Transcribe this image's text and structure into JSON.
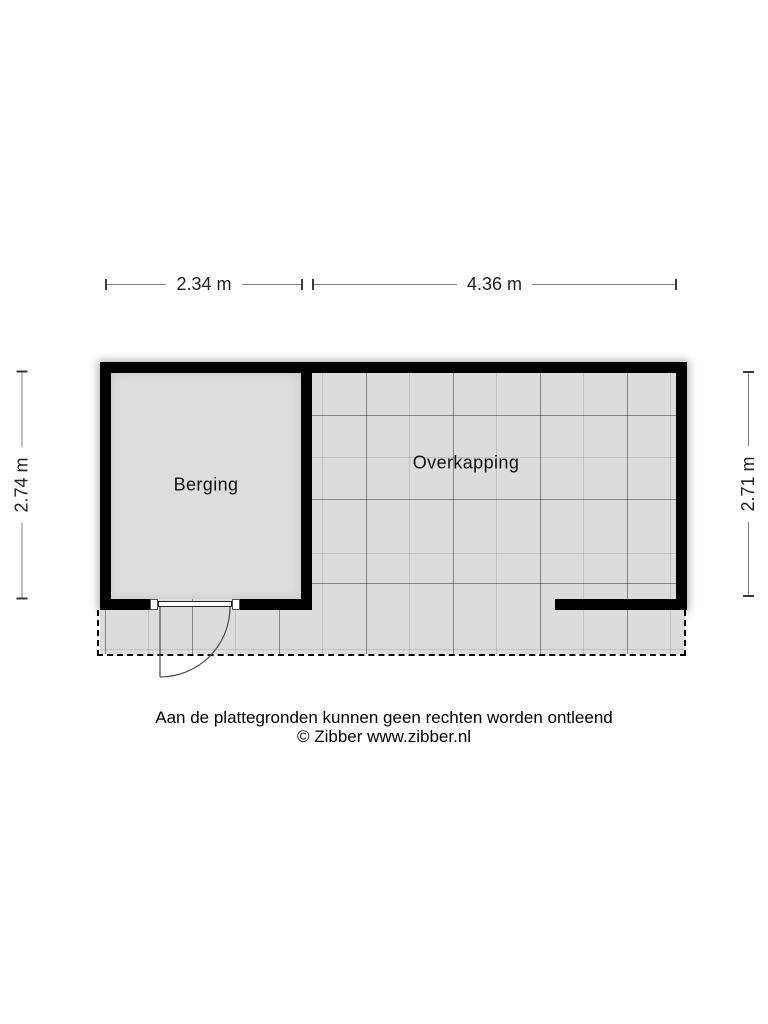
{
  "figure": {
    "type": "floor-plan",
    "provider": "Zibber"
  },
  "dimensions": {
    "top_left": "2.34 m",
    "top_right": "4.36 m",
    "left": "2.74 m",
    "right": "2.71 m"
  },
  "rooms": {
    "berging": {
      "label": "Berging"
    },
    "overkapping": {
      "label": "Overkapping"
    }
  },
  "footer": {
    "disclaimer": "Aan de plattegronden kunnen geen rechten worden ontleend",
    "copyright": "© Zibber www.zibber.nl"
  },
  "colors": {
    "wall": "#000000",
    "floor": "#dcdcdc",
    "grid_dark": "#666666",
    "grid_faint": "#c9c9c9",
    "dimension_line": "#7d7d7d",
    "dimension_tick": "#3a3a3a",
    "text": "#111111",
    "background": "#ffffff"
  }
}
